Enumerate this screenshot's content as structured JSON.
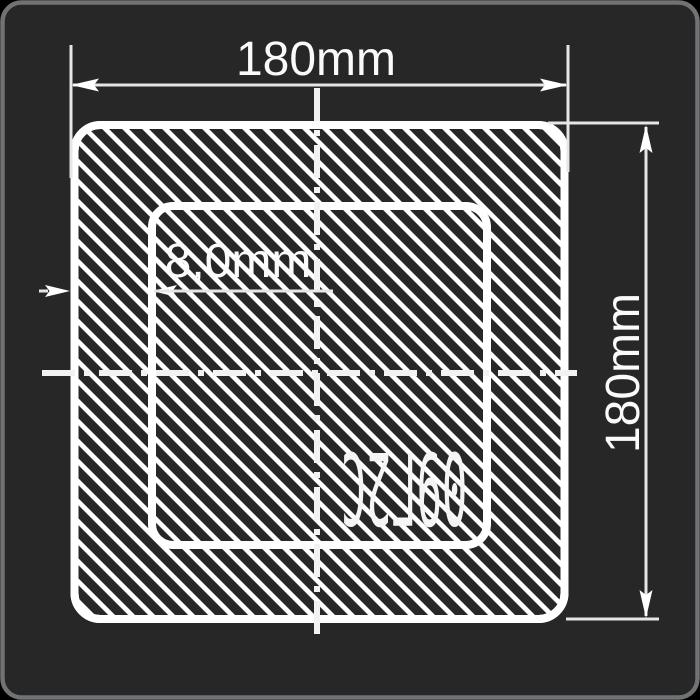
{
  "window": {
    "background": "#000000",
    "panel_background": "#272728",
    "panel_border": "#707274",
    "line_color": "#ffffff",
    "dim_line_color": "#e6e6e6"
  },
  "drawing": {
    "dimensions": {
      "outer_width": {
        "label": "180mm"
      },
      "outer_height": {
        "label": "180mm"
      },
      "wall_thickness": {
        "label": "8,0mm"
      }
    },
    "material": {
      "grade": "09Г2С"
    }
  }
}
